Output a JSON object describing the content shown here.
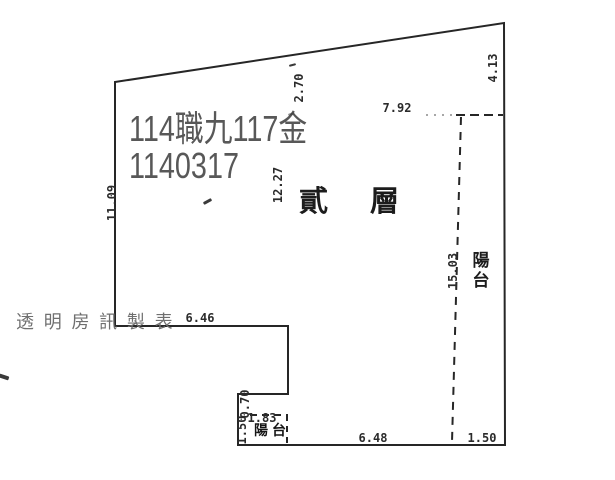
{
  "colors": {
    "ink": "#2b2b2b",
    "stamp_gray": "#585858",
    "watermark_gray": "#6f6f6f"
  },
  "stamp": {
    "line1": "114職九117金",
    "line2": "1140317"
  },
  "floor_label": {
    "first": "貳",
    "second": "層"
  },
  "right_balcony": {
    "first": "陽",
    "second": "台"
  },
  "small_balcony_label": "陽台",
  "watermark": "透 明 房 訊 製 表",
  "dimensions": {
    "top_edge": "2.70",
    "right_top": "4.13",
    "upper_width": "7.92",
    "left_height": "11.09",
    "interior_height": "12.27",
    "balcony_length": "15.03",
    "step_width": "6.46",
    "notch_depth": "0.70",
    "small_balcony_width": "1.83",
    "small_balcony_depth": "1.50",
    "bottom_width": "6.48",
    "balcony_width": "1.50"
  }
}
